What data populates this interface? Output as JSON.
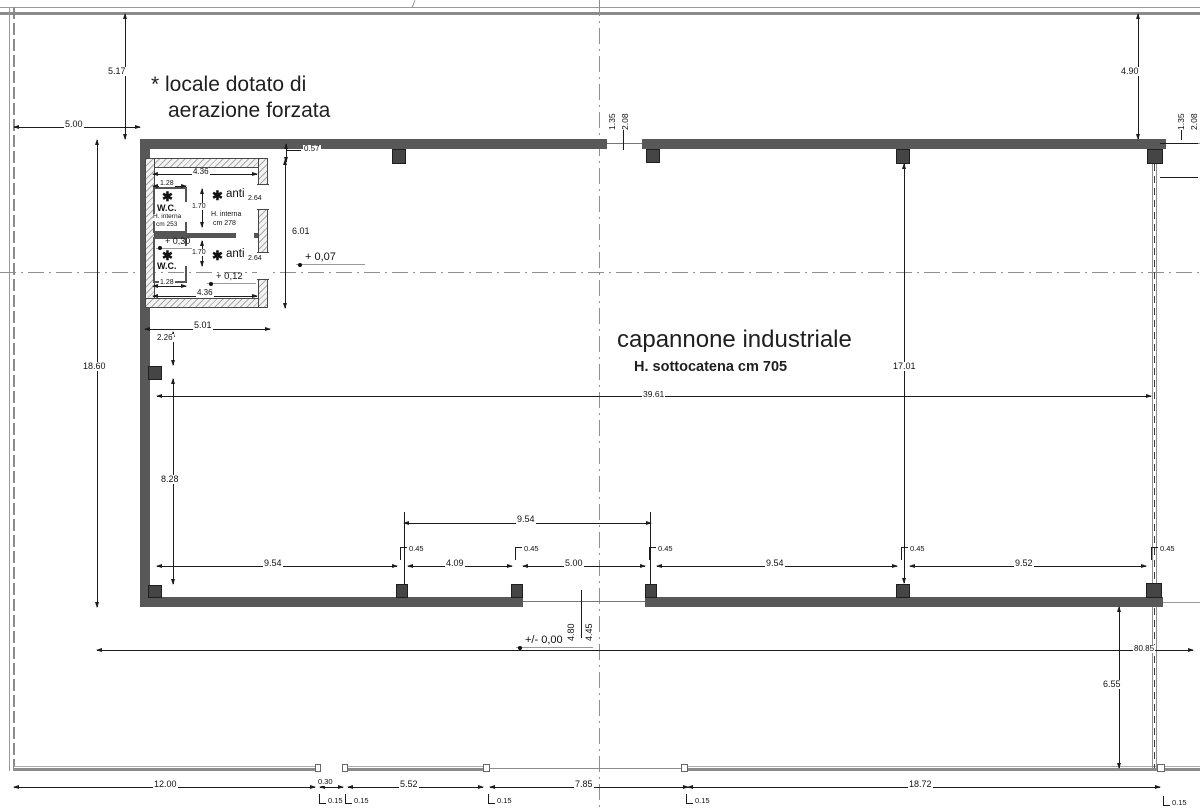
{
  "notes": {
    "forced_air_line1": "* locale dotato di",
    "forced_air_line2": "aerazione forzata"
  },
  "hall": {
    "name": "capannone industriale",
    "under_truss": "H. sottocatena cm 705"
  },
  "rooms": {
    "star": "✱",
    "wc": "W.C.",
    "anti": "anti",
    "h_interna": "H. interna",
    "cm253": "cm 253",
    "cm278": "cm 278",
    "anti_height": "2.64"
  },
  "levels": {
    "p030": "+ 0,30",
    "p012": "+ 0,12",
    "p007": "+ 0,07",
    "zero": "+/- 0,00"
  },
  "dims": {
    "d500": "5.00",
    "d517": "5.17",
    "d490": "4.90",
    "d1860": "18.60",
    "d057": "0.57",
    "d436": "4.36",
    "d128": "1.28",
    "d170": "1.70",
    "d601": "6.01",
    "d501": "5.01",
    "d226": "2.26",
    "d828": "8.28",
    "d954": "9.54",
    "d409": "4.09",
    "d952": "9.52",
    "d045": "0.45",
    "d3961": "39.61",
    "d1701": "17.01",
    "d135": "1.35",
    "d208": "2.08",
    "d480": "4.80",
    "d445": "4.45",
    "d8085": "80.85",
    "d655": "6.55",
    "d1200": "12.00",
    "d030": "0.30",
    "d015": "0.15",
    "d552": "5.52",
    "d785": "7.85",
    "d1872": "18.72"
  }
}
